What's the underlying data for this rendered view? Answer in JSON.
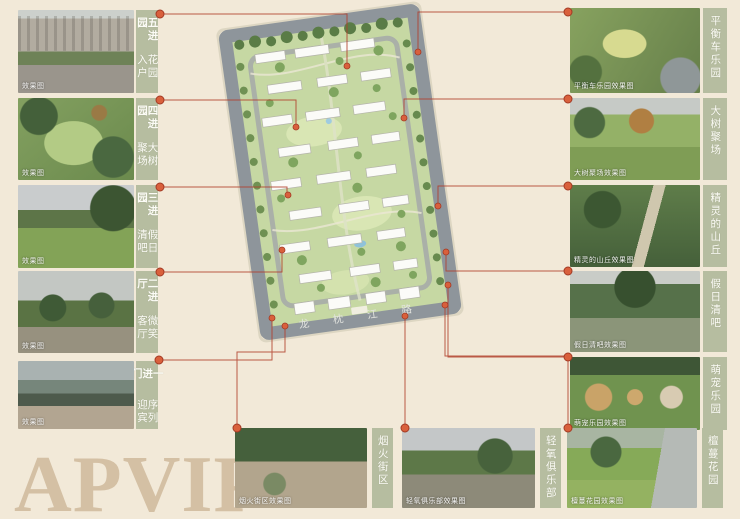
{
  "page": {
    "watermark": "APVIP",
    "background": "#f2e9d8"
  },
  "map": {
    "road_label": "龙枕江路",
    "site_green": "#c6d8a3",
    "road_gray": "#8e959b",
    "dot_color": "#d9603c",
    "line_color": "#b2402c"
  },
  "panels": {
    "left": [
      {
        "title": "五进园",
        "subtitle": "花园入户",
        "caption": "效果图"
      },
      {
        "title": "四进园",
        "subtitle": "大树聚场",
        "caption": "效果图"
      },
      {
        "title": "三进园",
        "subtitle": "假日清吧",
        "caption": "效果图"
      },
      {
        "title": "二进厅",
        "subtitle": "微笑客厅",
        "caption": "效果图"
      },
      {
        "title": "一进门",
        "subtitle": "序列迎宾",
        "caption": "效果图"
      }
    ],
    "right": [
      {
        "label": "平衡车乐园",
        "caption": "平衡车乐园效果图"
      },
      {
        "label": "大树聚场",
        "caption": "大树聚场效果图"
      },
      {
        "label": "精灵的山丘",
        "caption": "精灵的山丘效果图"
      },
      {
        "label": "假日清吧",
        "caption": "假日清吧效果图"
      },
      {
        "label": "萌宠乐园",
        "caption": "萌宠乐园效果图"
      }
    ],
    "bottom": [
      {
        "label": "烟火街区",
        "caption": "烟火街区效果图"
      },
      {
        "label": "轻氧俱乐部",
        "caption": "轻氧俱乐部效果图"
      },
      {
        "label": "檀蔓花园",
        "caption": "檀蔓花园效果图"
      }
    ]
  }
}
